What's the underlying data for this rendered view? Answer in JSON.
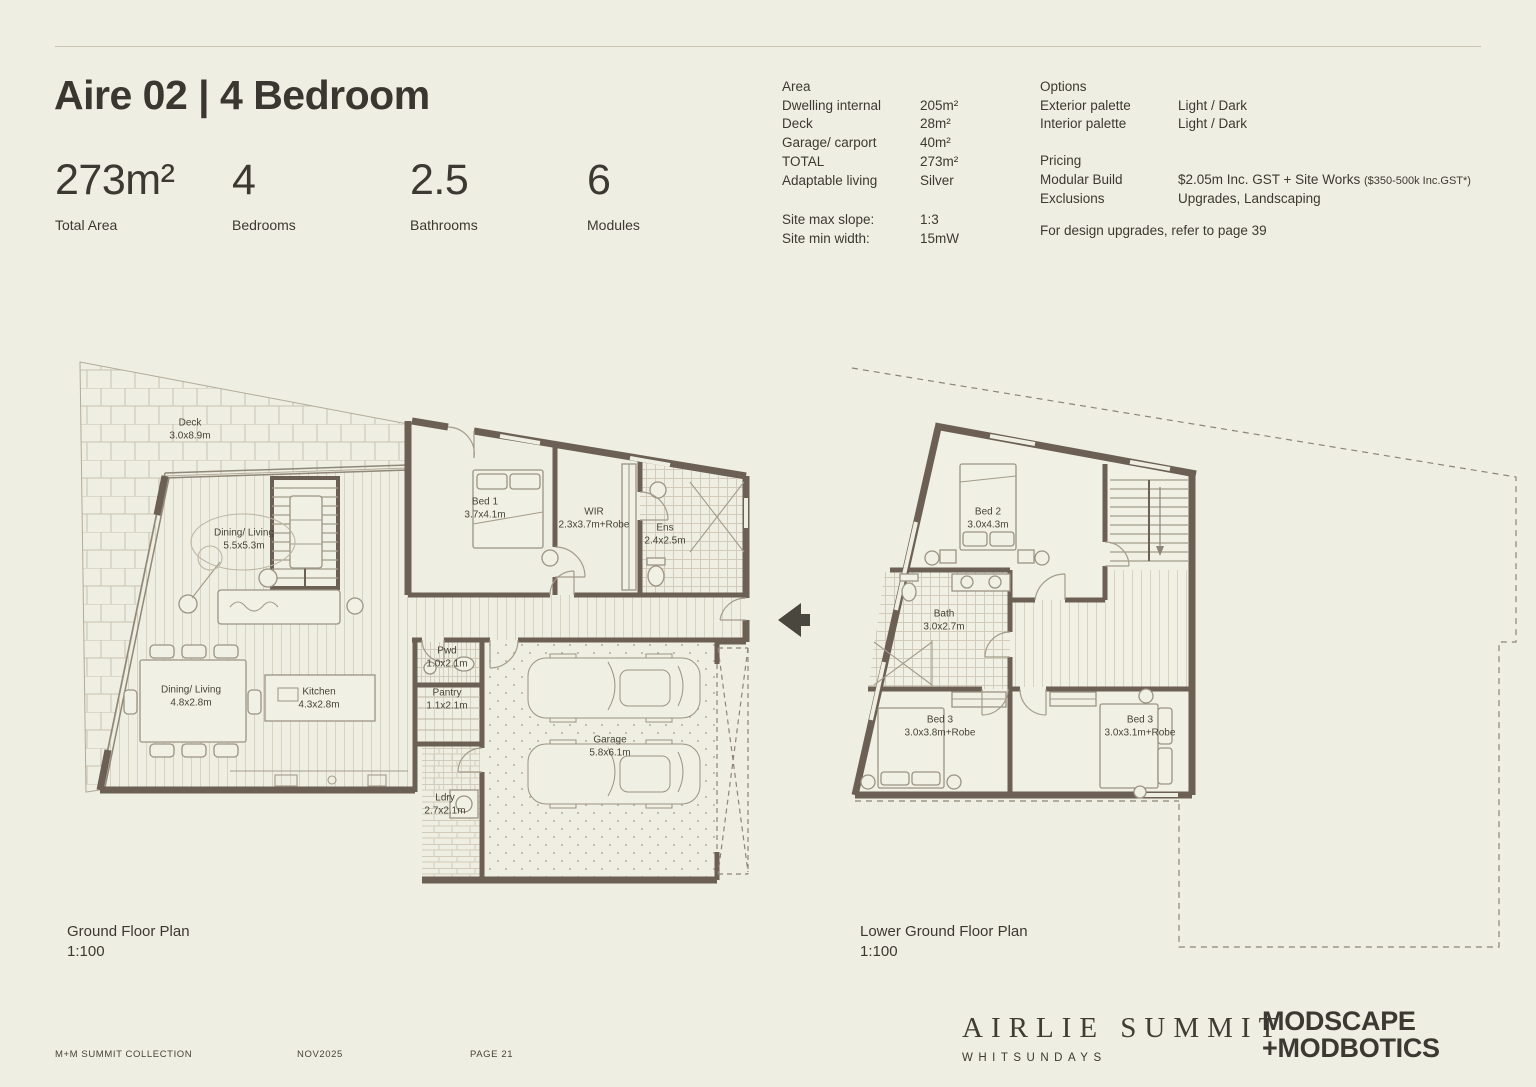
{
  "colors": {
    "background": "#efeee2",
    "ink": "#3b3931",
    "wall": "#6b6053",
    "line": "#a49c8b",
    "hatch": "#c7c0ae"
  },
  "header": {
    "title": "Aire 02 | 4 Bedroom",
    "stats": [
      {
        "value": "273m²",
        "label": "Total Area"
      },
      {
        "value": "4",
        "label": "Bedrooms"
      },
      {
        "value": "2.5",
        "label": "Bathrooms"
      },
      {
        "value": "6",
        "label": "Modules"
      }
    ]
  },
  "specs": {
    "area_heading": "Area",
    "area_rows": [
      {
        "label": "Dwelling internal",
        "value": "205m²"
      },
      {
        "label": "Deck",
        "value": "28m²"
      },
      {
        "label": "Garage/ carport",
        "value": "40m²"
      },
      {
        "label": "TOTAL",
        "value": "273m²"
      },
      {
        "label": "Adaptable living",
        "value": "Silver"
      }
    ],
    "site_rows": [
      {
        "label": "Site max slope:",
        "value": "1:3"
      },
      {
        "label": "Site min width:",
        "value": "15mW"
      }
    ],
    "options_heading": "Options",
    "options_rows": [
      {
        "label": "Exterior palette",
        "value": "Light / Dark"
      },
      {
        "label": "Interior palette",
        "value": "Light / Dark"
      }
    ],
    "pricing_heading": "Pricing",
    "pricing_rows": [
      {
        "label": "Modular Build",
        "value": "$2.05m Inc. GST + Site Works",
        "note": "($350-500k  Inc.GST*)"
      },
      {
        "label": "Exclusions",
        "value": "Upgrades, Landscaping",
        "note": ""
      }
    ],
    "upgrade_note": "For design upgrades, refer to page 39"
  },
  "plans": {
    "ground": {
      "caption": "Ground Floor Plan",
      "scale": "1:100",
      "rooms": [
        {
          "name": "Deck",
          "dims": "3.0x8.9m"
        },
        {
          "name": "Dining/ Living",
          "dims": "5.5x5.3m"
        },
        {
          "name": "Bed 1",
          "dims": "3.7x4.1m"
        },
        {
          "name": "WIR",
          "dims": "2.3x3.7m+Robe"
        },
        {
          "name": "Ens",
          "dims": "2.4x2.5m"
        },
        {
          "name": "Pwd",
          "dims": "1.0x2.1m"
        },
        {
          "name": "Pantry",
          "dims": "1.1x2.1m"
        },
        {
          "name": "Dining/ Living",
          "dims": "4.8x2.8m"
        },
        {
          "name": "Kitchen",
          "dims": "4.3x2.8m"
        },
        {
          "name": "Garage",
          "dims": "5.8x6.1m"
        },
        {
          "name": "Ldry",
          "dims": "2.7x2.1m"
        }
      ]
    },
    "lower": {
      "caption": "Lower Ground Floor Plan",
      "scale": "1:100",
      "rooms": [
        {
          "name": "Bed 2",
          "dims": "3.0x4.3m"
        },
        {
          "name": "Bath",
          "dims": "3.0x2.7m"
        },
        {
          "name": "Bed 3",
          "dims": "3.0x3.8m+Robe"
        },
        {
          "name": "Bed 3",
          "dims": "3.0x3.1m+Robe"
        }
      ]
    }
  },
  "footer": {
    "collection": "M+M SUMMIT COLLECTION",
    "date": "NOV2025",
    "page": "PAGE 21",
    "brand": {
      "name": "AIRLIE SUMMIT",
      "location": "WHITSUNDAYS"
    },
    "builder": {
      "line1": "MODSCAPE",
      "line2": "+MODBOTICS"
    }
  }
}
